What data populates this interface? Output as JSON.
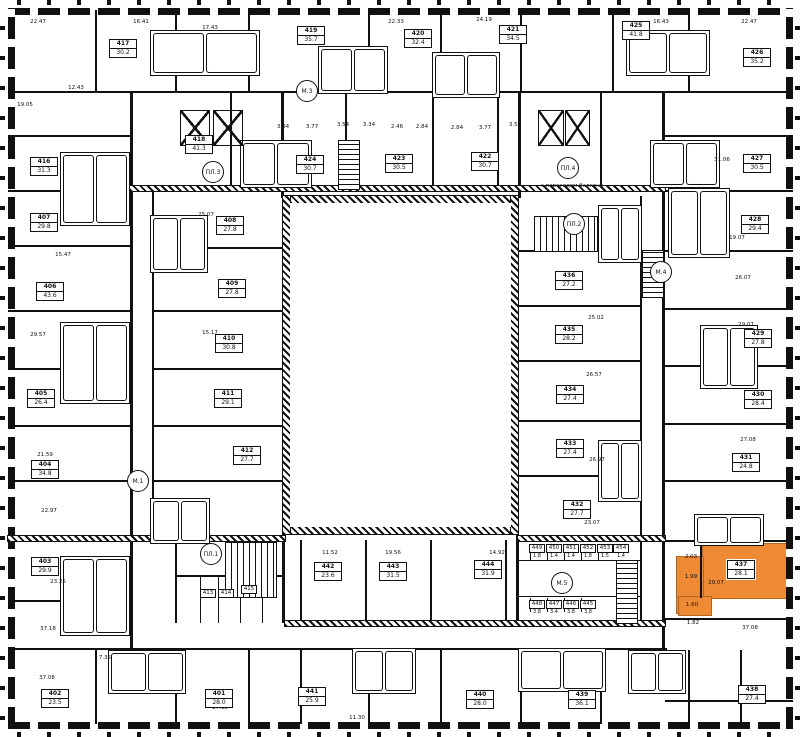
{
  "colors": {
    "wall": "#111111",
    "highlight": "#EE8A33",
    "highlight_border": "#B8641A"
  },
  "note": {
    "text": "с переходом балкона",
    "x": 572,
    "y": 183
  },
  "units": [
    {
      "n": "417",
      "a": "30.2",
      "x": 123,
      "y": 47
    },
    {
      "n": "419",
      "a": "35.7",
      "x": 311,
      "y": 34
    },
    {
      "n": "420",
      "a": "32.4",
      "x": 418,
      "y": 37
    },
    {
      "n": "421",
      "a": "34.5",
      "x": 513,
      "y": 33
    },
    {
      "n": "425",
      "a": "41.8",
      "x": 636,
      "y": 29
    },
    {
      "n": "426",
      "a": "35.2",
      "x": 757,
      "y": 56
    },
    {
      "n": "418",
      "a": "41.3",
      "x": 199,
      "y": 143
    },
    {
      "n": "424",
      "a": "30.7",
      "x": 310,
      "y": 163
    },
    {
      "n": "423",
      "a": "30.5",
      "x": 399,
      "y": 162
    },
    {
      "n": "422",
      "a": "30.7",
      "x": 485,
      "y": 160
    },
    {
      "n": "416",
      "a": "31.3",
      "x": 44,
      "y": 165
    },
    {
      "n": "407",
      "a": "29.8",
      "x": 44,
      "y": 221
    },
    {
      "n": "406",
      "a": "43.6",
      "x": 50,
      "y": 290
    },
    {
      "n": "405",
      "a": "26.4",
      "x": 41,
      "y": 397
    },
    {
      "n": "404",
      "a": "34.8",
      "x": 45,
      "y": 468
    },
    {
      "n": "403",
      "a": "29.9",
      "x": 45,
      "y": 565
    },
    {
      "n": "402",
      "a": "23.5",
      "x": 55,
      "y": 697
    },
    {
      "n": "401",
      "a": "28.0",
      "x": 219,
      "y": 697
    },
    {
      "n": "408",
      "a": "27.8",
      "x": 230,
      "y": 224
    },
    {
      "n": "409",
      "a": "27.8",
      "x": 232,
      "y": 287
    },
    {
      "n": "410",
      "a": "30.8",
      "x": 229,
      "y": 342
    },
    {
      "n": "411",
      "a": "29.1",
      "x": 228,
      "y": 397
    },
    {
      "n": "412",
      "a": "27.7",
      "x": 247,
      "y": 454
    },
    {
      "n": "427",
      "a": "30.5",
      "x": 757,
      "y": 162
    },
    {
      "n": "428",
      "a": "29.4",
      "x": 755,
      "y": 223
    },
    {
      "n": "429",
      "a": "27.8",
      "x": 758,
      "y": 337
    },
    {
      "n": "430",
      "a": "28.4",
      "x": 758,
      "y": 398
    },
    {
      "n": "431",
      "a": "24.8",
      "x": 746,
      "y": 461
    },
    {
      "n": "436",
      "a": "27.2",
      "x": 569,
      "y": 279
    },
    {
      "n": "435",
      "a": "28.2",
      "x": 569,
      "y": 333
    },
    {
      "n": "434",
      "a": "27.4",
      "x": 570,
      "y": 393
    },
    {
      "n": "433",
      "a": "27.4",
      "x": 570,
      "y": 447
    },
    {
      "n": "432",
      "a": "27.7",
      "x": 577,
      "y": 508
    },
    {
      "n": "442",
      "a": "23.6",
      "x": 328,
      "y": 570
    },
    {
      "n": "443",
      "a": "31.5",
      "x": 393,
      "y": 570
    },
    {
      "n": "444",
      "a": "31.9",
      "x": 488,
      "y": 568
    },
    {
      "n": "441",
      "a": "25.9",
      "x": 312,
      "y": 695
    },
    {
      "n": "440",
      "a": "28.0",
      "x": 480,
      "y": 698
    },
    {
      "n": "439",
      "a": "36.1",
      "x": 582,
      "y": 698
    },
    {
      "n": "438",
      "a": "27.4",
      "x": 752,
      "y": 693
    },
    {
      "n": "437",
      "a": "28.1",
      "x": 741,
      "y": 568,
      "hl": true
    }
  ],
  "small_rooms": [
    {
      "n": "413",
      "x": 208,
      "y": 593
    },
    {
      "n": "414",
      "x": 226,
      "y": 593
    },
    {
      "n": "415",
      "x": 249,
      "y": 589
    }
  ],
  "storage_units": [
    {
      "n": "449",
      "v": "1.8",
      "x": 537,
      "y": 548
    },
    {
      "n": "450",
      "v": "1.4",
      "x": 554,
      "y": 548
    },
    {
      "n": "451",
      "v": "1.4",
      "x": 571,
      "y": 548
    },
    {
      "n": "452",
      "v": "1.8",
      "x": 588,
      "y": 548
    },
    {
      "n": "453",
      "v": "1.5",
      "x": 605,
      "y": 548
    },
    {
      "n": "454",
      "v": "1.4",
      "x": 621,
      "y": 548
    },
    {
      "n": "448",
      "v": "3.8",
      "x": 537,
      "y": 604
    },
    {
      "n": "447",
      "v": "3.4",
      "x": 554,
      "y": 604
    },
    {
      "n": "446",
      "v": "3.8",
      "x": 571,
      "y": 604
    },
    {
      "n": "445",
      "v": "3.8",
      "x": 588,
      "y": 604
    }
  ],
  "markers": [
    {
      "t": "М.3",
      "x": 307,
      "y": 91
    },
    {
      "t": "ПЛ.3",
      "x": 213,
      "y": 172
    },
    {
      "t": "ПЛ.4",
      "x": 568,
      "y": 168
    },
    {
      "t": "ПЛ.2",
      "x": 574,
      "y": 224
    },
    {
      "t": "М.4",
      "x": 661,
      "y": 272
    },
    {
      "t": "М.1",
      "x": 138,
      "y": 481
    },
    {
      "t": "ПЛ.1",
      "x": 211,
      "y": 554
    },
    {
      "t": "М.5",
      "x": 562,
      "y": 583
    }
  ],
  "area_labels": [
    {
      "t": "22.47",
      "x": 38,
      "y": 22
    },
    {
      "t": "16.41",
      "x": 141,
      "y": 22
    },
    {
      "t": "17.43",
      "x": 210,
      "y": 28
    },
    {
      "t": "22.33",
      "x": 396,
      "y": 22
    },
    {
      "t": "24.19",
      "x": 484,
      "y": 20
    },
    {
      "t": "16.43",
      "x": 661,
      "y": 22
    },
    {
      "t": "22.47",
      "x": 749,
      "y": 22
    },
    {
      "t": "19.05",
      "x": 25,
      "y": 105
    },
    {
      "t": "12.43",
      "x": 76,
      "y": 88
    },
    {
      "t": "15.47",
      "x": 63,
      "y": 255
    },
    {
      "t": "29.57",
      "x": 38,
      "y": 335
    },
    {
      "t": "21.59",
      "x": 45,
      "y": 455
    },
    {
      "t": "22.97",
      "x": 49,
      "y": 511
    },
    {
      "t": "23.25",
      "x": 58,
      "y": 582
    },
    {
      "t": "37.18",
      "x": 48,
      "y": 629
    },
    {
      "t": "37.08",
      "x": 47,
      "y": 678
    },
    {
      "t": "31.06",
      "x": 722,
      "y": 160
    },
    {
      "t": "19.07",
      "x": 737,
      "y": 238
    },
    {
      "t": "26.07",
      "x": 743,
      "y": 278
    },
    {
      "t": "29.07",
      "x": 746,
      "y": 325
    },
    {
      "t": "27.08",
      "x": 748,
      "y": 440
    },
    {
      "t": "37.08",
      "x": 750,
      "y": 628
    },
    {
      "t": "29.07",
      "x": 716,
      "y": 583
    },
    {
      "t": "1.99",
      "x": 691,
      "y": 577
    },
    {
      "t": "1.60",
      "x": 692,
      "y": 605
    },
    {
      "t": "2.03",
      "x": 691,
      "y": 557
    },
    {
      "t": "1.82",
      "x": 693,
      "y": 623
    },
    {
      "t": "11.52",
      "x": 330,
      "y": 553
    },
    {
      "t": "19.56",
      "x": 393,
      "y": 553
    },
    {
      "t": "14.92",
      "x": 497,
      "y": 553
    },
    {
      "t": "7.35",
      "x": 105,
      "y": 658
    },
    {
      "t": "27.18",
      "x": 220,
      "y": 708
    },
    {
      "t": "11.30",
      "x": 357,
      "y": 718
    },
    {
      "t": "25.07",
      "x": 206,
      "y": 215
    },
    {
      "t": "15.17",
      "x": 210,
      "y": 333
    },
    {
      "t": "25.02",
      "x": 596,
      "y": 318
    },
    {
      "t": "26.57",
      "x": 594,
      "y": 375
    },
    {
      "t": "26.97",
      "x": 597,
      "y": 460
    },
    {
      "t": "23.07",
      "x": 592,
      "y": 523
    },
    {
      "t": "3.84",
      "x": 283,
      "y": 127
    },
    {
      "t": "3.77",
      "x": 312,
      "y": 127
    },
    {
      "t": "3.54",
      "x": 343,
      "y": 125
    },
    {
      "t": "3.34",
      "x": 369,
      "y": 125
    },
    {
      "t": "2.46",
      "x": 397,
      "y": 127
    },
    {
      "t": "2.84",
      "x": 422,
      "y": 127
    },
    {
      "t": "2.84",
      "x": 457,
      "y": 128
    },
    {
      "t": "3.77",
      "x": 485,
      "y": 128
    },
    {
      "t": "3.54",
      "x": 515,
      "y": 125
    }
  ],
  "plan": {
    "courtyard_interior": [
      290,
      203,
      221,
      324
    ],
    "hatch": [
      [
        283,
        196,
        235,
        7
      ],
      [
        283,
        527,
        235,
        7
      ],
      [
        283,
        196,
        7,
        338
      ],
      [
        511,
        196,
        7,
        338
      ],
      [
        130,
        186,
        535,
        5
      ],
      [
        8,
        536,
        277,
        5
      ],
      [
        518,
        536,
        147,
        5
      ],
      [
        285,
        621,
        380,
        5
      ]
    ],
    "walls": [
      [
        8,
        91,
        785,
        2
      ],
      [
        8,
        135,
        122,
        2
      ],
      [
        8,
        190,
        122,
        2
      ],
      [
        8,
        245,
        122,
        2
      ],
      [
        8,
        310,
        122,
        2
      ],
      [
        8,
        368,
        122,
        2
      ],
      [
        8,
        425,
        122,
        2
      ],
      [
        8,
        480,
        122,
        2
      ],
      [
        8,
        600,
        122,
        2
      ],
      [
        665,
        135,
        128,
        2
      ],
      [
        665,
        190,
        128,
        2
      ],
      [
        665,
        250,
        128,
        2
      ],
      [
        665,
        308,
        128,
        2
      ],
      [
        665,
        365,
        128,
        2
      ],
      [
        665,
        423,
        128,
        2
      ],
      [
        665,
        480,
        128,
        2
      ],
      [
        665,
        540,
        128,
        2
      ],
      [
        665,
        618,
        128,
        2
      ],
      [
        665,
        700,
        128,
        2
      ],
      [
        95,
        10,
        2,
        81
      ],
      [
        175,
        10,
        2,
        81
      ],
      [
        248,
        10,
        2,
        81
      ],
      [
        368,
        10,
        2,
        81
      ],
      [
        440,
        10,
        2,
        81
      ],
      [
        520,
        10,
        2,
        81
      ],
      [
        612,
        10,
        2,
        81
      ],
      [
        688,
        10,
        2,
        81
      ],
      [
        95,
        650,
        2,
        74
      ],
      [
        175,
        650,
        2,
        74
      ],
      [
        248,
        650,
        2,
        74
      ],
      [
        300,
        650,
        2,
        74
      ],
      [
        368,
        650,
        2,
        74
      ],
      [
        440,
        650,
        2,
        74
      ],
      [
        520,
        650,
        2,
        74
      ],
      [
        600,
        650,
        2,
        74
      ],
      [
        688,
        650,
        2,
        74
      ],
      [
        740,
        650,
        2,
        74
      ],
      [
        8,
        648,
        659,
        2
      ],
      [
        130,
        91,
        3,
        559
      ],
      [
        152,
        190,
        2,
        345
      ],
      [
        662,
        91,
        3,
        559
      ],
      [
        640,
        196,
        2,
        340
      ],
      [
        152,
        247,
        131,
        2
      ],
      [
        152,
        310,
        131,
        2
      ],
      [
        152,
        368,
        131,
        2
      ],
      [
        152,
        425,
        131,
        2
      ],
      [
        152,
        480,
        131,
        2
      ],
      [
        518,
        250,
        122,
        2
      ],
      [
        518,
        305,
        122,
        2
      ],
      [
        518,
        360,
        122,
        2
      ],
      [
        518,
        420,
        122,
        2
      ],
      [
        518,
        475,
        122,
        2
      ],
      [
        230,
        91,
        2,
        97
      ],
      [
        281,
        91,
        3,
        107
      ],
      [
        345,
        91,
        2,
        97
      ],
      [
        432,
        91,
        2,
        97
      ],
      [
        497,
        91,
        2,
        97
      ],
      [
        518,
        91,
        3,
        107
      ],
      [
        600,
        91,
        2,
        97
      ],
      [
        282,
        533,
        3,
        90
      ],
      [
        516,
        533,
        3,
        90
      ],
      [
        300,
        540,
        2,
        83
      ],
      [
        365,
        540,
        2,
        83
      ],
      [
        430,
        540,
        2,
        83
      ],
      [
        505,
        540,
        2,
        83
      ],
      [
        640,
        537,
        2,
        86
      ],
      [
        530,
        546,
        1,
        14
      ],
      [
        547,
        546,
        1,
        14
      ],
      [
        564,
        546,
        1,
        14
      ],
      [
        581,
        546,
        1,
        14
      ],
      [
        598,
        546,
        1,
        14
      ],
      [
        530,
        598,
        1,
        14
      ],
      [
        547,
        598,
        1,
        14
      ],
      [
        564,
        598,
        1,
        14
      ],
      [
        581,
        598,
        1,
        14
      ],
      [
        518,
        560,
        122,
        1
      ],
      [
        518,
        596,
        122,
        1
      ],
      [
        175,
        575,
        107,
        2
      ],
      [
        200,
        577,
        1,
        46
      ],
      [
        218,
        577,
        1,
        46
      ],
      [
        240,
        577,
        1,
        46
      ],
      [
        262,
        577,
        1,
        46
      ],
      [
        175,
        537,
        2,
        86
      ],
      [
        700,
        543,
        2,
        55
      ]
    ],
    "clusters": [
      [
        150,
        30,
        110,
        46
      ],
      [
        318,
        46,
        70,
        48
      ],
      [
        432,
        52,
        68,
        46
      ],
      [
        626,
        30,
        84,
        46
      ],
      [
        240,
        140,
        72,
        48
      ],
      [
        650,
        140,
        70,
        48
      ],
      [
        60,
        152,
        70,
        74
      ],
      [
        60,
        322,
        70,
        82
      ],
      [
        60,
        556,
        70,
        80
      ],
      [
        150,
        215,
        58,
        58
      ],
      [
        150,
        498,
        60,
        46
      ],
      [
        598,
        205,
        44,
        58
      ],
      [
        598,
        440,
        44,
        62
      ],
      [
        668,
        188,
        62,
        70
      ],
      [
        700,
        325,
        58,
        64
      ],
      [
        694,
        514,
        70,
        32
      ],
      [
        108,
        650,
        78,
        44
      ],
      [
        352,
        648,
        64,
        46
      ],
      [
        518,
        648,
        88,
        44
      ],
      [
        628,
        650,
        58,
        44
      ]
    ],
    "stairs": [
      [
        225,
        542,
        52,
        56,
        "h"
      ],
      [
        534,
        216,
        64,
        36,
        "h"
      ],
      [
        338,
        140,
        22,
        50,
        "v"
      ],
      [
        616,
        560,
        22,
        64,
        "v"
      ],
      [
        642,
        250,
        22,
        48,
        "v"
      ]
    ],
    "shafts": [
      [
        180,
        110,
        30,
        36
      ],
      [
        213,
        110,
        30,
        36
      ],
      [
        538,
        110,
        26,
        36
      ],
      [
        565,
        110,
        25,
        36
      ]
    ],
    "highlight_rects": [
      [
        702,
        543,
        90,
        56
      ],
      [
        676,
        556,
        28,
        58
      ],
      [
        678,
        596,
        34,
        20
      ]
    ]
  }
}
